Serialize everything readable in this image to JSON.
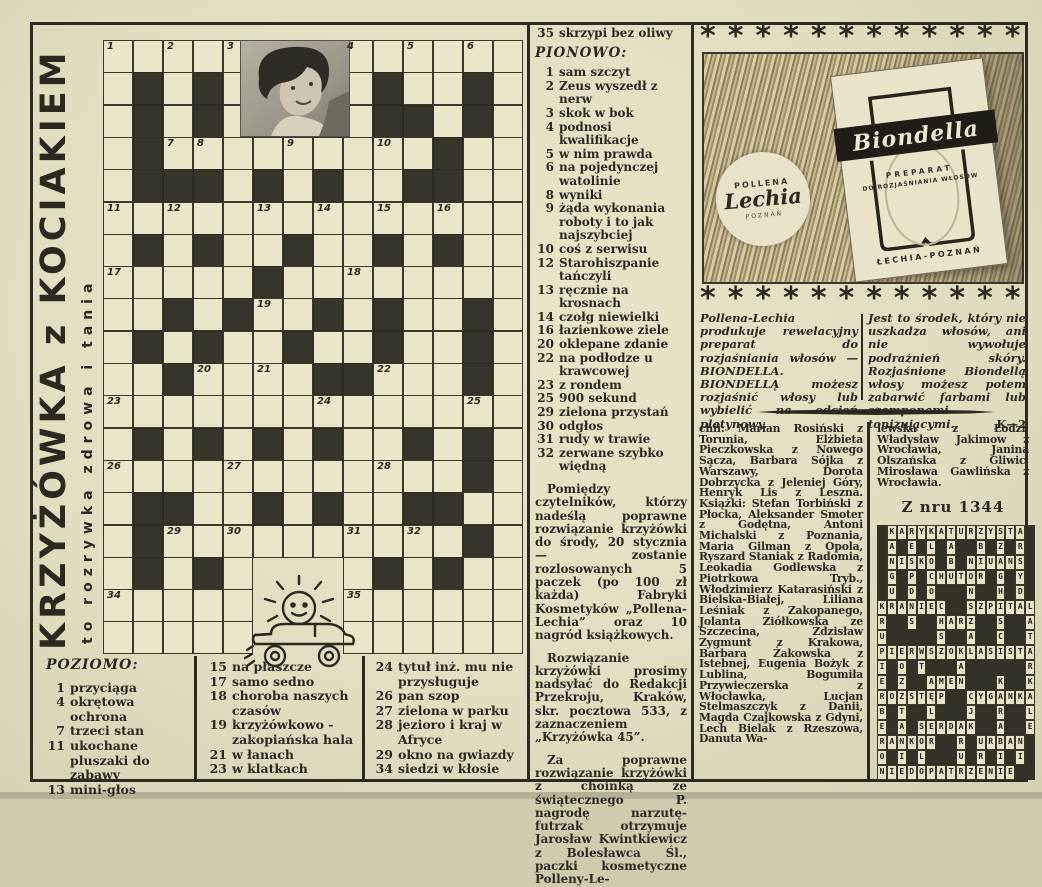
{
  "title": {
    "main": "KRZYŻÓWKA z KOCIAKIEM",
    "subtitle": "to rozrywka zdrowa i tania"
  },
  "colors": {
    "paper": "#e5e1c5",
    "ink": "#2b2920",
    "grid_black": "#37342a"
  },
  "crossword": {
    "rows": 19,
    "cols": 14,
    "pattern": [
      ".....PPP......",
      ".#.#.PPP.#..#.",
      ".#.#.PPP.##.#.",
      ".#.........#..",
      ".###.#.#..##..",
      "..............",
      ".#.#..#..#.#..",
      ".....#........",
      "..#.#..#.#..#.",
      ".#.#..#..#..#.",
      "..#....##...#.",
      "..............",
      ".#.#.#.#..#.#.",
      "............#.",
      ".##..#.#..##..",
      ".#..........#.",
      ".#.#.XXX.#.#..",
      ".....XXX......",
      ".....XXX......"
    ],
    "numbers": [
      [
        1,
        1,
        "1"
      ],
      [
        1,
        3,
        "2"
      ],
      [
        1,
        5,
        "3"
      ],
      [
        1,
        9,
        "4"
      ],
      [
        1,
        11,
        "5"
      ],
      [
        1,
        13,
        "6"
      ],
      [
        4,
        3,
        "7"
      ],
      [
        4,
        4,
        "8"
      ],
      [
        4,
        7,
        "9"
      ],
      [
        4,
        10,
        "10"
      ],
      [
        6,
        1,
        "11"
      ],
      [
        6,
        3,
        "12"
      ],
      [
        6,
        6,
        "13"
      ],
      [
        6,
        8,
        "14"
      ],
      [
        6,
        10,
        "15"
      ],
      [
        6,
        12,
        "16"
      ],
      [
        8,
        1,
        "17"
      ],
      [
        8,
        9,
        "18"
      ],
      [
        9,
        6,
        "19"
      ],
      [
        11,
        4,
        "20"
      ],
      [
        11,
        6,
        "21"
      ],
      [
        11,
        10,
        "22"
      ],
      [
        12,
        1,
        "23"
      ],
      [
        12,
        8,
        "24"
      ],
      [
        12,
        13,
        "25"
      ],
      [
        14,
        1,
        "26"
      ],
      [
        14,
        5,
        "27"
      ],
      [
        14,
        10,
        "28"
      ],
      [
        16,
        3,
        "29"
      ],
      [
        16,
        5,
        "30"
      ],
      [
        16,
        9,
        "31"
      ],
      [
        16,
        11,
        "32"
      ],
      [
        18,
        1,
        "34"
      ],
      [
        18,
        9,
        "35"
      ]
    ]
  },
  "poziomo": {
    "heading": "POZIOMO:",
    "col1": [
      [
        "1",
        "przyciąga"
      ],
      [
        "4",
        "okrętowa ochrona"
      ],
      [
        "7",
        "trzeci stan"
      ],
      [
        "11",
        "ukochane pluszaki do zabawy"
      ],
      [
        "13",
        "mini-głos"
      ]
    ],
    "col2": [
      [
        "15",
        "na płaszcze"
      ],
      [
        "17",
        "samo sedno"
      ],
      [
        "18",
        "choroba naszych czasów"
      ],
      [
        "19",
        "krzyżówkowo - zakopiańska hala"
      ],
      [
        "21",
        "w łanach"
      ],
      [
        "23",
        "w klatkach"
      ]
    ],
    "col3": [
      [
        "24",
        "tytuł inż. mu nie przysługuje"
      ],
      [
        "26",
        "pan szop"
      ],
      [
        "27",
        "zielona w parku"
      ],
      [
        "28",
        "jezioro i kraj w Afryce"
      ],
      [
        "29",
        "okno na gwiazdy"
      ],
      [
        "34",
        "siedzi w kłosie"
      ]
    ]
  },
  "pionowo": {
    "pre_clue": [
      [
        "35",
        "skrzypi bez oliwy"
      ]
    ],
    "heading": "PIONOWO:",
    "clues": [
      [
        "1",
        "sam szczyt"
      ],
      [
        "2",
        "Zeus wyszedł z nerw"
      ],
      [
        "3",
        "skok w bok"
      ],
      [
        "4",
        "podnosi kwalifikacje"
      ],
      [
        "5",
        "w nim prawda"
      ],
      [
        "6",
        "na pojedynczej watolinie"
      ],
      [
        "8",
        "wyniki"
      ],
      [
        "9",
        "żąda wykonania roboty i to jak najszybciej"
      ],
      [
        "10",
        "coś z serwisu"
      ],
      [
        "12",
        "Starohiszpanie tańczyli"
      ],
      [
        "13",
        "ręcznie na krosnach"
      ],
      [
        "14",
        "czołg niewielki"
      ],
      [
        "16",
        "łazienkowe ziele"
      ],
      [
        "20",
        "oklepane zdanie"
      ],
      [
        "22",
        "na podłodze u krawcowej"
      ],
      [
        "23",
        "z rondem"
      ],
      [
        "25",
        "900 sekund"
      ],
      [
        "29",
        "zielona przystań"
      ],
      [
        "30",
        "odgłos"
      ],
      [
        "31",
        "rudy w trawie"
      ],
      [
        "32",
        "zerwane szybko więdną"
      ]
    ],
    "paragraphs": [
      "Pomiędzy czytelników, którzy nadeślą poprawne rozwiązanie krzyżówki do środy, 20 stycznia — zostanie rozlosowanych 5 paczek (po 100 zł każda) Fabryki Kosmetyków „Pollena-Lechia” oraz 10 nagród książkowych.",
      "Rozwiązanie krzyżówki prosimy nadsyłać do Redakcji Przekroju, Kraków, skr. pocztowa 533, z zaznaczeniem „Krzyżówka 45”.",
      "Za poprawne rozwiązanie krzyżówki z choinką ze świątecznego P. nagrodę narzutę-futrzak otrzymuje Jarosław Kwintkiewicz z Bolesławca Śl., paczki kosmetyczne Polleny-Le-"
    ]
  },
  "ad": {
    "star_char": "*",
    "stars_count": 12,
    "logo": {
      "line1": "POLLENA",
      "line2": "Lechia",
      "line3": "POZNAŃ"
    },
    "package": {
      "brand": "Biondella",
      "line1": "PREPARAT",
      "line2": "DO ROZJAŚNIANIA WŁOSÓW",
      "footer": "ŁECHIA-POZNAŃ"
    },
    "text_left": "Pollena-Lechia produkuje rewelacyjny preparat do rozjaśniania włosów — BIONDELLA. BIONDELLĄ możesz rozjaśnić włosy lub wybielić na odcień platynowy.",
    "text_right": "Jest to środek, który nie uszkadza włosów, ani nie wywołuje podrażnień skóry. Rozjaśnione Biondellą włosy możesz potem zabarwić farbami lub szamponami tonizującymi.",
    "sig": "K—2"
  },
  "winners": {
    "left": "chii: Marian Rosiński z Torunia, Elżbieta Pieczkowska z Nowego Sącza, Barbara Sójka z Warszawy, Dorota Dobrzycka z Jeleniej Góry, Henryk Lis z Leszna. Książki: Stefan Torbiński z Płocka, Aleksander Smoter z Godętna, Antoni Michalski z Poznania, Maria Gilman z Opola, Ryszard Staniak z Radomia, Leokadia Godlewska z Piotrkowa Tryb., Włodzimierz Katarasiński z Bielska-Białej, Liliana Leśniak z Zakopanego, Jolanta Ziółkowska ze Szczecina, Zdzisław Zygmunt z Krakowa, Barbara Żakowska z Istebnej, Eugenia Bożyk z Lublina, Bogumiła Przywieczerska z Włocławka, Lucjan Stelmaszczyk z Danii, Magda Czajkowska z Gdyni, Lech Bielak z Rzeszowa, Danuta Wa-",
    "right": "lewska z Łodzi, Władysław Jakimow z Wrocławia, Janina Olszańska z Gliwic, Mirosława Gawlińska z Wrocławia.",
    "heading": "Z nru 1344"
  },
  "solution": {
    "rows": [
      " KARYKATURZYSTA ",
      " A E L A  B Z R ",
      " NISKO B NIUANS ",
      " G P CHUTOR G Y ",
      " U D O   N  H D ",
      "KRANIEC  SZPITAL",
      "R  S  HARZ  S  A",
      "U     S  A  C  T",
      "PIERWSZOKLASISTA",
      "I O T   A      R",
      "E Z  AMEN   K  K",
      "ROZSTĘP  CYGANKA",
      "B T  L   J  R  L",
      "E A SERDAK  A  E",
      "RANKOR  R URBAN ",
      "O I L   U R I I ",
      "NIEDOPATRZENIE  "
    ]
  }
}
